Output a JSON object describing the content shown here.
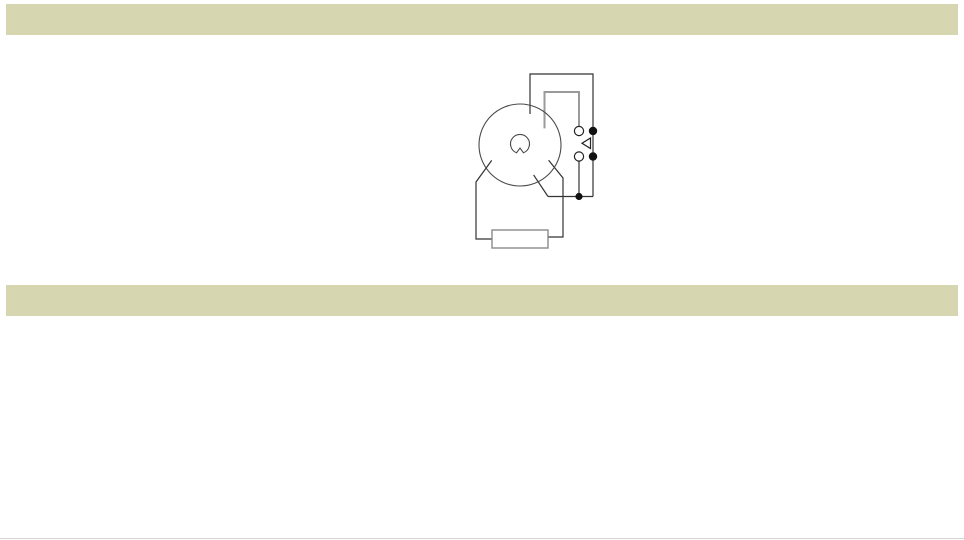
{
  "banners": {
    "connection": "CONNECTION :",
    "timing": "TIMING CHART :"
  },
  "colors": {
    "banner_bg": "#d6d7b1",
    "pulse_fill": "#f9d2d2",
    "pulse_stroke": "#7d6363",
    "gray_light": "#c2c2c2",
    "gray_dark": "#6e6e6e",
    "wire": "#333333"
  },
  "connection": {
    "pins": [
      "1",
      "2",
      "3",
      "4",
      "5",
      "6",
      "7",
      "8"
    ],
    "source_label": "SOURCE",
    "minus_label": "−",
    "plus_label": "+"
  },
  "timing_chart": {
    "type": "timing",
    "rows": [
      {
        "label": "SOURCE  (2-7)",
        "pulses": [
          {
            "x1": 423,
            "x2": 468
          },
          {
            "x1": 530,
            "x2": 573
          }
        ]
      },
      {
        "label": "N.C.  (8-5)",
        "pulses": [
          {
            "x1": 404,
            "x2": 423,
            "edge": "torn-left"
          },
          {
            "x1": 514,
            "x2": 530
          },
          {
            "x1": 618,
            "x2": 637,
            "edge": "torn-right"
          }
        ]
      },
      {
        "label": "N.O.  (8-6)",
        "pulses": [
          {
            "x1": 423,
            "x2": 514
          },
          {
            "x1": 530,
            "x2": 618
          }
        ]
      },
      {
        "label": "LAMP",
        "pulses": [
          {
            "x1": 423,
            "x2": 468
          },
          {
            "x1": 530,
            "x2": 573
          }
        ]
      }
    ],
    "axis_x": 423,
    "x_start": 405,
    "x_end": 637,
    "guides": [
      {
        "x": 468,
        "style": "dark-dashed",
        "tick": true
      },
      {
        "x": 514,
        "style": "gray"
      },
      {
        "x": 530,
        "style": "dark-dashed",
        "tick": true
      },
      {
        "x": 573,
        "style": "dark-dashed",
        "tick": true
      },
      {
        "x": 618,
        "style": "gray"
      }
    ],
    "markers": [
      {
        "label": "St",
        "from": 468,
        "to": 514,
        "style": "inward"
      },
      {
        "label": "Rt",
        "from": 514,
        "to": 530,
        "style": "outward"
      },
      {
        "label": "St",
        "from": 573,
        "to": 618,
        "style": "inward"
      }
    ],
    "legend": {
      "st": "St : Setting time",
      "rt": "Rt:Restting time"
    }
  }
}
